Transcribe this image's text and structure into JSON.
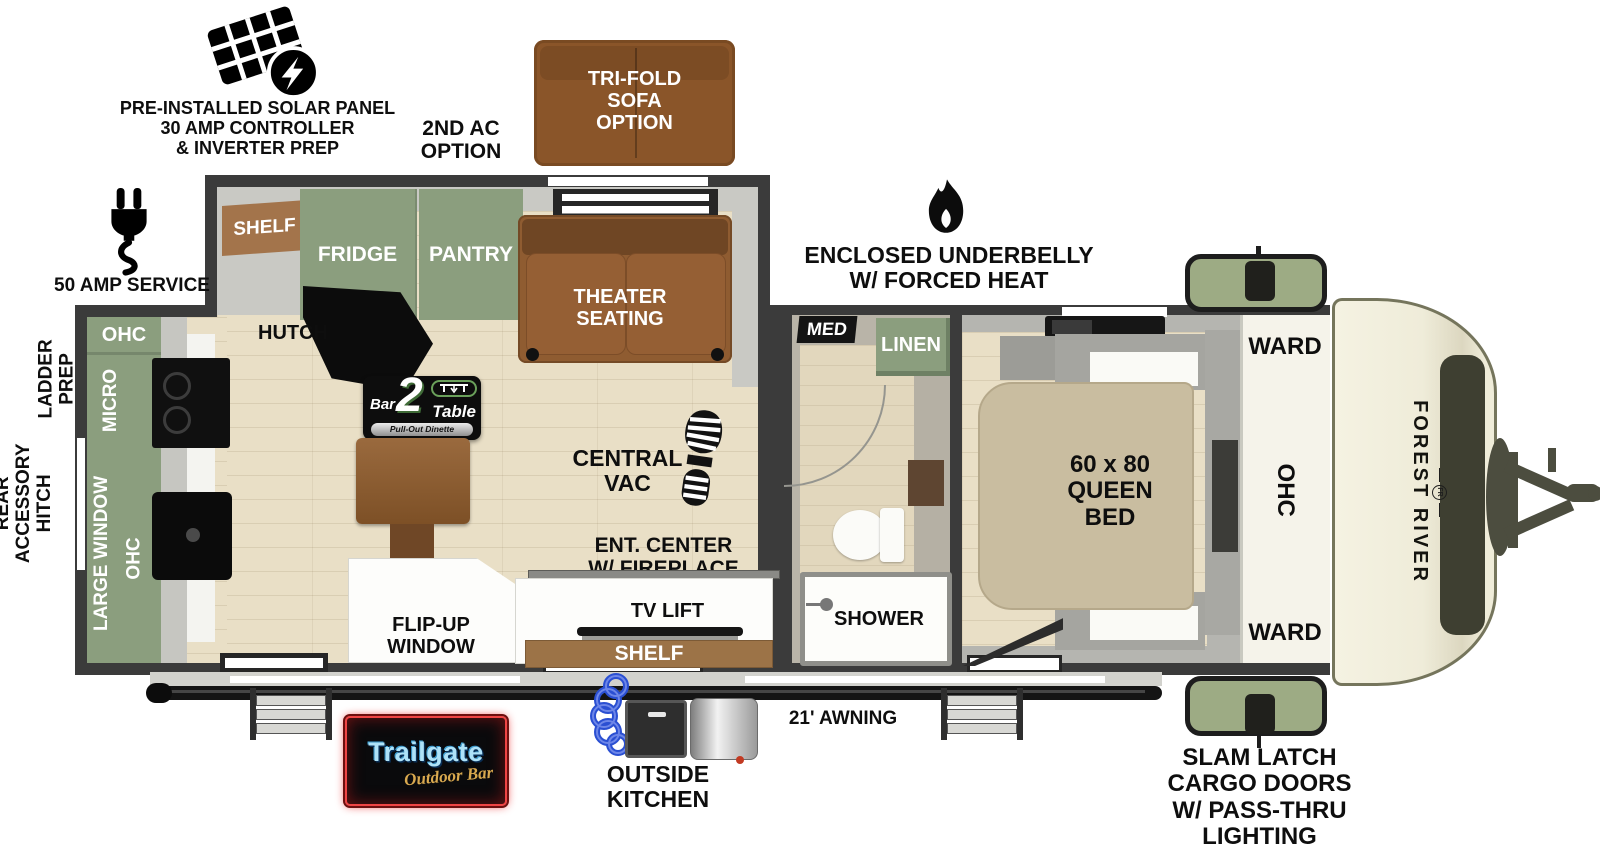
{
  "callouts": {
    "solar": "PRE-INSTALLED SOLAR PANEL\n30 AMP CONTROLLER\n& INVERTER PREP",
    "second_ac": "2ND AC\nOPTION",
    "tri_fold_sofa": "TRI-FOLD\nSOFA\nOPTION",
    "service_50_amp": "50 AMP SERVICE",
    "ladder_prep": "LADDER\nPREP",
    "rear_accessory_hitch": "REAR\nACCESSORY\nHITCH",
    "enclosed_underbelly": "ENCLOSED UNDERBELLY\nW/ FORCED HEAT",
    "awning": "21' AWNING",
    "outside_kitchen": "OUTSIDE\nKITCHEN",
    "slam_latch": "SLAM LATCH\nCARGO DOORS\nW/ PASS-THRU\nLIGHTING"
  },
  "living_area": {
    "shelf_upper": "SHELF",
    "fridge": "FRIDGE",
    "pantry": "PANTRY",
    "hutch": "HUTCH",
    "theater_seating": "THEATER\nSEATING",
    "central_vac": "CENTRAL\nVAC",
    "ent_center": "ENT. CENTER\nW/ FIREPLACE",
    "tv_lift": "TV LIFT",
    "shelf_lower": "SHELF",
    "flip_up_window": "FLIP-UP\nWINDOW",
    "dinette_logo": {
      "bar": "Bar",
      "num": "2",
      "table": "Table",
      "tagline": "Pull-Out Dinette"
    }
  },
  "kitchen": {
    "ohc_upper": "OHC",
    "micro": "MICRO",
    "large_window": "LARGE WINDOW",
    "ohc_lower": "OHC"
  },
  "bathroom": {
    "med": "MED",
    "linen": "LINEN",
    "shower": "SHOWER"
  },
  "bedroom": {
    "queen_bed": "60 x 80\nQUEEN\nBED",
    "ward_upper": "WARD",
    "ohc": "OHC",
    "ward_lower": "WARD"
  },
  "exterior": {
    "brand": "FOREST RIVER",
    "brand_emblem": "FR",
    "trailgate_title": "Trailgate",
    "trailgate_subtitle": "Outdoor Bar"
  },
  "colors": {
    "wall": "#3b3b3b",
    "floor_wood": "#e9dfc6",
    "cabinet_green": "#8b9e7e",
    "sofa_brown": "#8f5c31",
    "shelf_brown": "#9c7347",
    "bed_tan": "#c9bda0",
    "front_cap_cream": "#efecd9",
    "hitch_olive": "#4c4d3f",
    "cargo_door_green": "#9dab84",
    "neon_blue": "#aee2f8",
    "neon_gold": "#d9a94f",
    "neon_red": "#ef4545"
  }
}
